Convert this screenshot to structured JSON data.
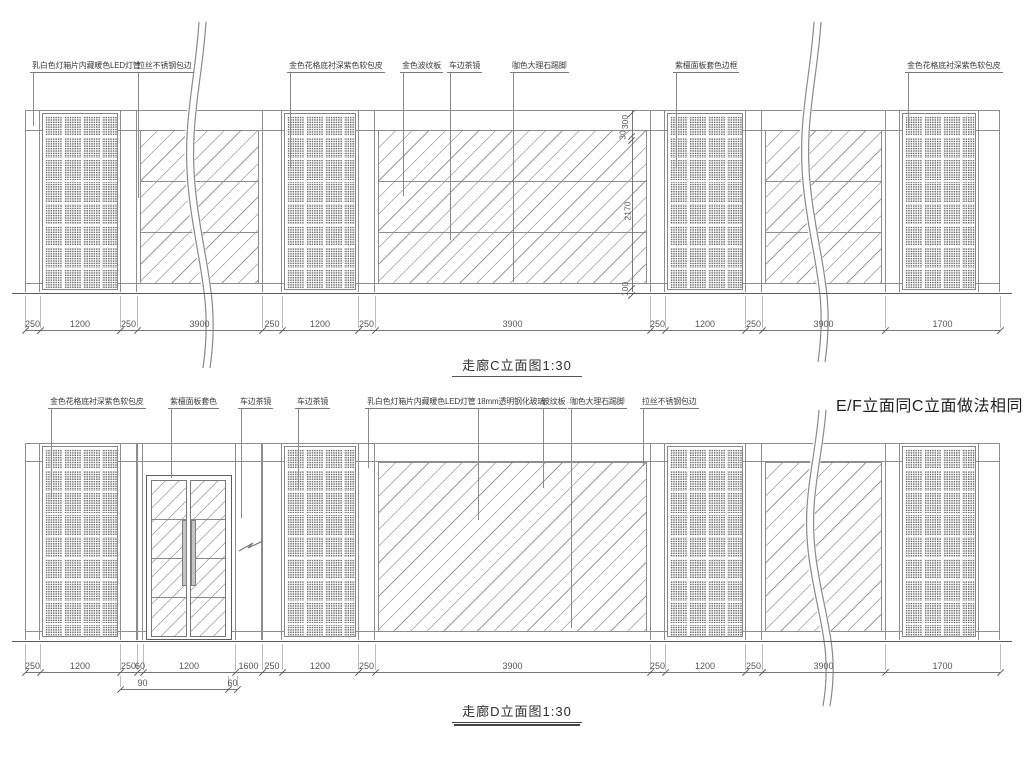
{
  "colors": {
    "line": "#8d8d8d",
    "ink": "#3c3c3c",
    "background": "#ffffff"
  },
  "note_ef": "E/F立面同C立面做法相同",
  "drawing_c": {
    "title": "走廊C立面图1:30",
    "annotations": [
      {
        "text": "乳白色灯箱片内藏暖色LED灯管",
        "x": 30,
        "lx": 33,
        "drop": 126
      },
      {
        "text": "拉丝不锈钢包边",
        "x": 135,
        "lx": 138,
        "drop": 198
      },
      {
        "text": "金色花格底衬深紫色软包皮",
        "x": 287,
        "lx": 290,
        "drop": 168
      },
      {
        "text": "金色波纹板",
        "x": 400,
        "lx": 403,
        "drop": 196
      },
      {
        "text": "车边茶镜",
        "x": 447,
        "lx": 450,
        "drop": 240
      },
      {
        "text": "咖色大理石踢脚",
        "x": 510,
        "lx": 513,
        "drop": 282
      },
      {
        "text": "紫檀面板套色边框",
        "x": 673,
        "lx": 676,
        "drop": 168
      },
      {
        "text": "金色花格底衬深紫色软包皮",
        "x": 905,
        "lx": 908,
        "drop": 128
      }
    ],
    "dims": [
      {
        "label": "250",
        "from": 25,
        "to": 40
      },
      {
        "label": "1200",
        "from": 40,
        "to": 120
      },
      {
        "label": "250",
        "from": 120,
        "to": 137
      },
      {
        "label": "3900",
        "from": 137,
        "to": 262
      },
      {
        "label": "250",
        "from": 262,
        "to": 282
      },
      {
        "label": "1200",
        "from": 282,
        "to": 358
      },
      {
        "label": "250",
        "from": 358,
        "to": 375
      },
      {
        "label": "3900",
        "from": 375,
        "to": 650
      },
      {
        "label": "250",
        "from": 650,
        "to": 665
      },
      {
        "label": "1200",
        "from": 665,
        "to": 745
      },
      {
        "label": "250",
        "from": 745,
        "to": 762
      },
      {
        "label": "3900",
        "from": 762,
        "to": 885
      },
      {
        "label": "1700",
        "from": 885,
        "to": 1000
      }
    ],
    "vdims": [
      {
        "label": "300",
        "from": 110,
        "to": 133
      },
      {
        "label": "30",
        "from": 133,
        "to": 137
      },
      {
        "label": "2170",
        "from": 137,
        "to": 285
      },
      {
        "label": "100",
        "from": 285,
        "to": 292
      }
    ],
    "sections": [
      {
        "type": "strip",
        "from": 25,
        "to": 40
      },
      {
        "type": "lattice",
        "from": 42,
        "to": 118
      },
      {
        "type": "strip",
        "from": 120,
        "to": 137
      },
      {
        "type": "glass",
        "from": 140,
        "to": 259,
        "grid": true
      },
      {
        "type": "strip",
        "from": 262,
        "to": 282
      },
      {
        "type": "lattice",
        "from": 284,
        "to": 356
      },
      {
        "type": "strip",
        "from": 358,
        "to": 375
      },
      {
        "type": "glass",
        "from": 378,
        "to": 647,
        "grid": true
      },
      {
        "type": "strip",
        "from": 650,
        "to": 665
      },
      {
        "type": "lattice",
        "from": 667,
        "to": 743
      },
      {
        "type": "strip",
        "from": 745,
        "to": 762
      },
      {
        "type": "glass",
        "from": 765,
        "to": 882,
        "grid": true
      },
      {
        "type": "strip",
        "from": 885,
        "to": 900
      },
      {
        "type": "lattice",
        "from": 902,
        "to": 976
      },
      {
        "type": "strip",
        "from": 978,
        "to": 1000
      }
    ]
  },
  "drawing_d": {
    "title": "走廊D立面图1:30",
    "annotations": [
      {
        "text": "金色花格底衬深紫色软包皮",
        "x": 48,
        "lx": 51,
        "drop": 498
      },
      {
        "text": "紫檀面板套色",
        "x": 168,
        "lx": 171,
        "drop": 478
      },
      {
        "text": "车边茶镜",
        "x": 238,
        "lx": 241,
        "drop": 518
      },
      {
        "text": "车边茶镜",
        "x": 295,
        "lx": 298,
        "drop": 490
      },
      {
        "text": "乳白色灯箱片内藏暖色LED灯管",
        "x": 365,
        "lx": 368,
        "drop": 468
      },
      {
        "text": "18mm透明钢化玻璃",
        "x": 475,
        "lx": 478,
        "drop": 520
      },
      {
        "text": "波纹板",
        "x": 540,
        "lx": 543,
        "drop": 488
      },
      {
        "text": "咖色大理石踢脚",
        "x": 568,
        "lx": 571,
        "drop": 628
      },
      {
        "text": "拉丝不锈钢包边",
        "x": 640,
        "lx": 643,
        "drop": 466
      }
    ],
    "dims": [
      {
        "label": "250",
        "from": 25,
        "to": 40
      },
      {
        "label": "1200",
        "from": 40,
        "to": 120
      },
      {
        "label": "250",
        "from": 120,
        "to": 137
      },
      {
        "label": "60",
        "from": 137,
        "to": 143
      },
      {
        "label": "1200",
        "from": 143,
        "to": 235
      },
      {
        "label": "1600",
        "from": 235,
        "to": 262
      },
      {
        "label": "250",
        "from": 262,
        "to": 282
      },
      {
        "label": "1200",
        "from": 282,
        "to": 358
      },
      {
        "label": "250",
        "from": 358,
        "to": 375
      },
      {
        "label": "3900",
        "from": 375,
        "to": 650
      },
      {
        "label": "250",
        "from": 650,
        "to": 665
      },
      {
        "label": "1200",
        "from": 665,
        "to": 745
      },
      {
        "label": "250",
        "from": 745,
        "to": 762
      },
      {
        "label": "3900",
        "from": 762,
        "to": 885
      },
      {
        "label": "1700",
        "from": 885,
        "to": 1000
      }
    ],
    "dims2": [
      {
        "label": "90",
        "from": 120,
        "to": 165
      },
      {
        "label": "60",
        "from": 228,
        "to": 237
      }
    ],
    "sections": [
      {
        "type": "strip",
        "from": 25,
        "to": 40
      },
      {
        "type": "lattice",
        "from": 42,
        "to": 118
      },
      {
        "type": "strip",
        "from": 120,
        "to": 137
      },
      {
        "type": "strip",
        "from": 137,
        "to": 143
      },
      {
        "type": "strip",
        "from": 235,
        "to": 262
      },
      {
        "type": "strip",
        "from": 262,
        "to": 282
      },
      {
        "type": "lattice",
        "from": 284,
        "to": 356
      },
      {
        "type": "strip",
        "from": 358,
        "to": 375
      },
      {
        "type": "glass",
        "from": 378,
        "to": 647,
        "grid": false
      },
      {
        "type": "strip",
        "from": 650,
        "to": 665
      },
      {
        "type": "lattice",
        "from": 667,
        "to": 743
      },
      {
        "type": "strip",
        "from": 745,
        "to": 762
      },
      {
        "type": "glass",
        "from": 765,
        "to": 882,
        "grid": false
      },
      {
        "type": "strip",
        "from": 885,
        "to": 900
      },
      {
        "type": "lattice",
        "from": 902,
        "to": 976
      },
      {
        "type": "strip",
        "from": 978,
        "to": 1000
      }
    ]
  }
}
